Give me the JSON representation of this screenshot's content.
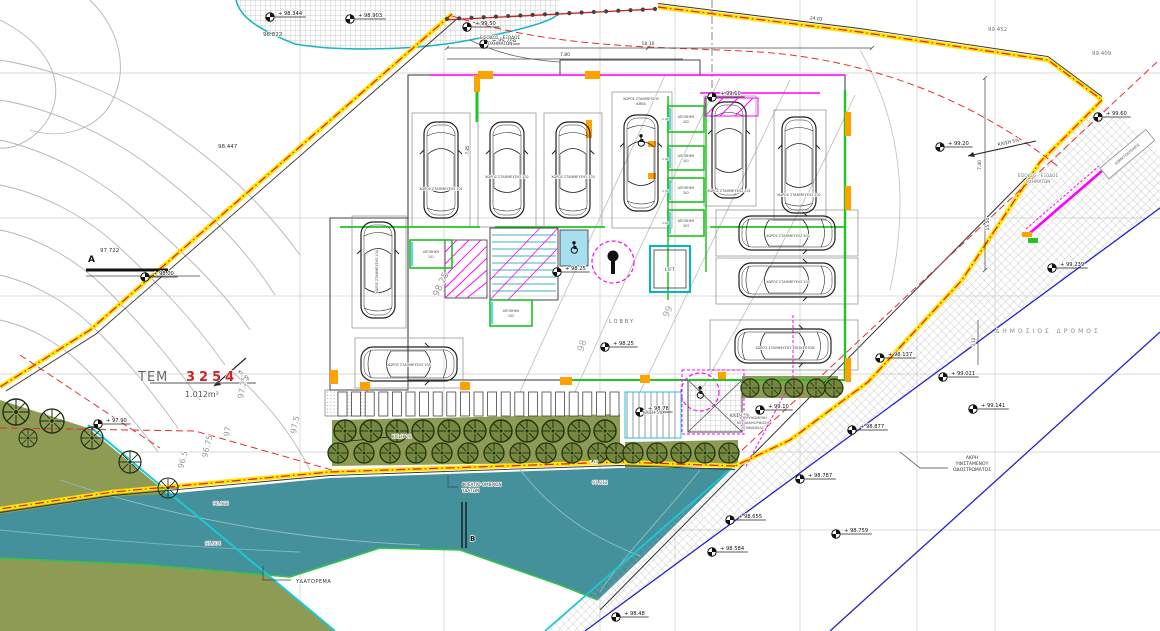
{
  "drawing": {
    "type": "topographic-site-plan",
    "parcel": {
      "id_prefix": "ΤΕΜ",
      "id_number": "3254",
      "area": "1.012m²"
    },
    "colors": {
      "water": "#44919b",
      "olive": "#8d9b55",
      "boundary_yellow": "#ffe500",
      "boundary_red": "#e01818",
      "wall_green": "#22c422",
      "wall_magenta": "#ff00ff",
      "road_blue": "#2222cc",
      "accent_orange": "#ffa200",
      "parcel_red": "#d42222"
    }
  },
  "markers": [
    {
      "x": 270,
      "y": 17,
      "t": "+ 98.344"
    },
    {
      "x": 350,
      "y": 19,
      "t": "+ 98.903"
    },
    {
      "x": 484,
      "y": 44,
      "t": "+ 99.268"
    },
    {
      "x": 467,
      "y": 27,
      "t": "+ 99.50"
    },
    {
      "x": 940,
      "y": 147,
      "t": "+ 99.20"
    },
    {
      "x": 1098,
      "y": 117,
      "t": "+ 99.60"
    },
    {
      "x": 1052,
      "y": 268,
      "t": "+ 99.239"
    },
    {
      "x": 943,
      "y": 377,
      "t": "+ 99.021"
    },
    {
      "x": 973,
      "y": 409,
      "t": "+ 99.141"
    },
    {
      "x": 852,
      "y": 430,
      "t": "+ 98.877"
    },
    {
      "x": 800,
      "y": 479,
      "t": "+ 98.787"
    },
    {
      "x": 730,
      "y": 520,
      "t": "+ 98.655"
    },
    {
      "x": 712,
      "y": 552,
      "t": "+ 98.584"
    },
    {
      "x": 836,
      "y": 534,
      "t": "+ 98.759"
    },
    {
      "x": 616,
      "y": 617,
      "t": "+ 98.48"
    },
    {
      "x": 145,
      "y": 277,
      "t": "+ 98.00"
    },
    {
      "x": 98,
      "y": 424,
      "t": "+ 97.90"
    },
    {
      "x": 605,
      "y": 347,
      "t": "+ 98.25"
    },
    {
      "x": 557,
      "y": 272,
      "t": "+ 98.25"
    },
    {
      "x": 712,
      "y": 97,
      "t": "+ 99.10"
    },
    {
      "x": 640,
      "y": 412,
      "t": "+ 98.78"
    },
    {
      "x": 760,
      "y": 410,
      "t": "+ 99.10"
    },
    {
      "x": 880,
      "y": 358,
      "t": "+ 98.137"
    }
  ],
  "texts": [
    {
      "x": 263,
      "y": 36,
      "t": "98.822",
      "s": 5.5
    },
    {
      "x": 218,
      "y": 148,
      "t": "98.447",
      "s": 5.5
    },
    {
      "x": 100,
      "y": 252,
      "t": "97.722",
      "s": 5.5
    },
    {
      "x": 988,
      "y": 31,
      "t": "99.452",
      "s": 5.5,
      "c": "#777"
    },
    {
      "x": 1092,
      "y": 55,
      "t": "99.409",
      "s": 5.5,
      "c": "#777"
    },
    {
      "x": 592,
      "y": 484,
      "t": "97.812",
      "s": 4.5,
      "c": "#555"
    },
    {
      "x": 205,
      "y": 545,
      "t": "97.004",
      "s": 4.5,
      "c": "#556"
    },
    {
      "x": 213,
      "y": 505,
      "t": "96.988",
      "s": 4.5,
      "c": "#556"
    },
    {
      "x": 500,
      "y": 39,
      "t": "ΕΙΣΟΔΟΣ - ΕΞΟΔΟΣ",
      "s": 4.2,
      "a": "middle"
    },
    {
      "x": 500,
      "y": 45,
      "t": "ΟΧΗΜΑΤΩΝ",
      "s": 4.2,
      "a": "middle"
    },
    {
      "x": 1038,
      "y": 177,
      "t": "ΕΙΣΟΔΟΣ - ΕΞΟΔΟΣ",
      "s": 4.2,
      "a": "middle",
      "c": "#777"
    },
    {
      "x": 1038,
      "y": 183,
      "t": "ΟΧΗΜΑΤΩΝ",
      "s": 4.2,
      "a": "middle",
      "c": "#777"
    },
    {
      "x": 138,
      "y": 381,
      "t": "ΤΕΜ",
      "s": 13,
      "c": "#666",
      "ls": 1
    },
    {
      "x": 186,
      "y": 381,
      "t": "3254",
      "s": 13,
      "c": "#d42222",
      "w": "bold",
      "ls": 4
    },
    {
      "x": 185,
      "y": 397,
      "t": "1.012m²",
      "s": 8,
      "c": "#555"
    },
    {
      "x": 296,
      "y": 583,
      "t": "ΥΔΑΤΟΡΕΜΑ",
      "s": 5,
      "ls": 0.5
    },
    {
      "x": 462,
      "y": 486,
      "t": "ΦΡΕΑΤΙΟ ΟΜΒΡΙΩΝ",
      "s": 4.2
    },
    {
      "x": 462,
      "y": 492,
      "t": "ΥΔΑΤΩΝ",
      "s": 4.2
    },
    {
      "x": 1048,
      "y": 333,
      "t": "ΔΗΜΟΣΙΟΣ ΔΡΟΜΟΣ",
      "s": 6,
      "c": "#8a8a8a",
      "ls": 3,
      "a": "middle"
    },
    {
      "x": 972,
      "y": 459,
      "t": "ΑΚΡΗ",
      "s": 4.5,
      "a": "middle"
    },
    {
      "x": 972,
      "y": 465,
      "t": "ΥΦΙΣΤΑΜΕΝΟΥ",
      "s": 4.5,
      "a": "middle"
    },
    {
      "x": 972,
      "y": 471,
      "t": "ΟΔΟΣΤΡΩΜΑΤΟΣ",
      "s": 4.5,
      "a": "middle"
    },
    {
      "x": 438,
      "y": 297,
      "t": "98.25",
      "s": 9,
      "r": -65,
      "c": "#999"
    },
    {
      "x": 583,
      "y": 352,
      "t": "98",
      "s": 9,
      "r": -72,
      "c": "#aaa"
    },
    {
      "x": 668,
      "y": 318,
      "t": "99",
      "s": 9,
      "r": -65,
      "c": "#aaa"
    },
    {
      "x": 243,
      "y": 399,
      "t": "97.25",
      "s": 8,
      "r": -78,
      "c": "#999"
    },
    {
      "x": 296,
      "y": 434,
      "t": "97.5",
      "s": 8,
      "r": -80,
      "c": "#999"
    },
    {
      "x": 229,
      "y": 437,
      "t": "97",
      "s": 8,
      "r": -80,
      "c": "#999"
    },
    {
      "x": 207,
      "y": 458,
      "t": "96.75",
      "s": 8,
      "r": -76,
      "c": "#999"
    },
    {
      "x": 183,
      "y": 469,
      "t": "96.5",
      "s": 8,
      "r": -74,
      "c": "#999"
    },
    {
      "x": 643,
      "y": 414,
      "t": "ΚΛΙΣΗ 5%",
      "s": 4
    },
    {
      "x": 730,
      "y": 417,
      "t": "ΚΛΙΣΗ 5%",
      "s": 4
    },
    {
      "x": 998,
      "y": 146,
      "t": "ΚΛΙΣΗ 5%",
      "s": 4.5,
      "r": -12
    },
    {
      "x": 392,
      "y": 438,
      "t": "ΚΛΙΣΗ 7%",
      "s": 4
    },
    {
      "x": 238,
      "y": 372,
      "t": "ΚΛ. 5%",
      "s": 3.8,
      "r": 40
    },
    {
      "x": 753,
      "y": 419,
      "t": "ΥΠΕΡΥΨΩΜΕΝΗ",
      "s": 3.6,
      "a": "middle",
      "c": "#555"
    },
    {
      "x": 753,
      "y": 424,
      "t": "ΝΕΟΔΙΑΜΟΡΦΩΣΗ",
      "s": 3.6,
      "a": "middle",
      "c": "#555"
    },
    {
      "x": 753,
      "y": 429,
      "t": "ΕΠΙΦΑΝΕΙΑΣ",
      "s": 3.6,
      "a": "middle",
      "c": "#555"
    },
    {
      "x": 441,
      "y": 190,
      "t": "ΧΩΡΟΣ ΣΤΑΘΜΕΥΣΗΣ 101",
      "s": 3.4,
      "a": "middle",
      "c": "#444"
    },
    {
      "x": 507,
      "y": 178,
      "t": "ΧΩΡΟΣ ΣΤΑΘΜΕΥΣΗΣ 102",
      "s": 3.4,
      "a": "middle",
      "c": "#444"
    },
    {
      "x": 573,
      "y": 178,
      "t": "ΧΩΡΟΣ ΣΤΑΘΜΕΥΣΗΣ 103",
      "s": 3.4,
      "a": "middle",
      "c": "#444"
    },
    {
      "x": 641,
      "y": 100,
      "t": "ΧΩΡΟΣ ΣΤΑΘΜΕΥΣΗΣ",
      "s": 3.4,
      "a": "middle",
      "c": "#444"
    },
    {
      "x": 641,
      "y": 105,
      "t": "ΑΜΕΑ",
      "s": 3.4,
      "a": "middle",
      "c": "#444"
    },
    {
      "x": 729,
      "y": 192,
      "t": "ΧΩΡΟΣ ΣΤΑΘΜΕΥΣΗΣ 201",
      "s": 3.4,
      "a": "middle",
      "c": "#444"
    },
    {
      "x": 799,
      "y": 196,
      "t": "ΧΩΡΟΣ ΣΤΑΘΜΕΥΣΗΣ 202",
      "s": 3.4,
      "a": "middle",
      "c": "#444"
    },
    {
      "x": 788,
      "y": 237,
      "t": "ΧΩΡΟΣ ΣΤΑΘΜΕΥΣΗΣ 302",
      "s": 3.4,
      "a": "middle",
      "c": "#444"
    },
    {
      "x": 788,
      "y": 283,
      "t": "ΧΩΡΟΣ ΣΤΑΘΜΕΥΣΗΣ 203",
      "s": 3.4,
      "a": "middle",
      "c": "#444"
    },
    {
      "x": 785,
      "y": 349,
      "t": "ΧΩΡΟΣ ΣΤΑΘΜΕΥΣΗΣ ΕΠΙΣΚΕΠΤΩΝ",
      "s": 3.4,
      "a": "middle",
      "c": "#444"
    },
    {
      "x": 378,
      "y": 272,
      "t": "ΧΩΡΟΣ ΣΤΑΘΜΕΥΣΗΣ 104",
      "s": 3.4,
      "a": "middle",
      "c": "#444",
      "r": -90
    },
    {
      "x": 409,
      "y": 366,
      "t": "ΧΩΡΟΣ ΣΤΑΘΜΕΥΣΗΣ 105",
      "s": 3.4,
      "a": "middle",
      "c": "#444"
    },
    {
      "x": 670,
      "y": 271,
      "t": "LIFT",
      "s": 4,
      "a": "middle",
      "ls": 0.5
    },
    {
      "x": 622,
      "y": 323,
      "t": "LOBBY",
      "s": 5,
      "c": "#666",
      "ls": 2,
      "a": "middle"
    },
    {
      "x": 648,
      "y": 45,
      "t": "18.10",
      "s": 4.5,
      "a": "middle"
    },
    {
      "x": 565,
      "y": 56,
      "t": "7.80",
      "s": 4.5,
      "a": "middle"
    },
    {
      "x": 816,
      "y": 20,
      "t": "24.03",
      "s": 4.5,
      "r": 7,
      "a": "middle"
    },
    {
      "x": 981,
      "y": 165,
      "t": "7.40",
      "s": 4.5,
      "r": -90,
      "a": "middle"
    },
    {
      "x": 989,
      "y": 224,
      "t": "15.50",
      "s": 4.5,
      "r": -90,
      "a": "middle"
    },
    {
      "x": 975,
      "y": 342,
      "t": "3.10",
      "s": 4,
      "r": -90,
      "a": "middle"
    },
    {
      "x": 469,
      "y": 150,
      "t": "7.85",
      "s": 4,
      "r": -90,
      "a": "middle"
    },
    {
      "x": 662,
      "y": 120,
      "t": "1.45",
      "s": 3
    },
    {
      "x": 662,
      "y": 160,
      "t": "1.40",
      "s": 3
    },
    {
      "x": 662,
      "y": 192,
      "t": "1.30",
      "s": 3
    },
    {
      "x": 662,
      "y": 224,
      "t": "1.20",
      "s": 3
    },
    {
      "x": 590,
      "y": 463,
      "t": "1.40",
      "s": 3.5,
      "c": "#444"
    },
    {
      "x": 88,
      "y": 262,
      "t": "A",
      "s": 9,
      "w": "bold",
      "c": "#111"
    },
    {
      "x": 470,
      "y": 541,
      "t": "B",
      "s": 7,
      "w": "bold",
      "c": "#111"
    },
    {
      "x": 1128,
      "y": 155,
      "t": "ΧΩΜΑΤΟΔΡΟΜΟΣ",
      "s": 3.6,
      "r": -40,
      "a": "middle",
      "c": "#555"
    }
  ],
  "storages": [
    {
      "x": 668,
      "y": 106,
      "w": 36,
      "h": 26,
      "label": "ΑΠΟΘΗΚΗ 202"
    },
    {
      "x": 668,
      "y": 146,
      "w": 36,
      "h": 24,
      "label": "ΑΠΟΘΗΚΗ 301"
    },
    {
      "x": 668,
      "y": 178,
      "w": 36,
      "h": 24,
      "label": "ΑΠΟΘΗΚΗ 302"
    },
    {
      "x": 668,
      "y": 210,
      "w": 36,
      "h": 26,
      "label": "ΑΠΟΘΗΚΗ 303"
    },
    {
      "x": 410,
      "y": 240,
      "w": 42,
      "h": 28,
      "label": "ΑΠΟΘΗΚΗ 101"
    },
    {
      "x": 490,
      "y": 300,
      "w": 42,
      "h": 26,
      "label": "ΑΠΟΘΗΚΗ 102"
    }
  ],
  "bays": [
    [
      412,
      113,
      58,
      114
    ],
    [
      478,
      113,
      58,
      114
    ],
    [
      544,
      113,
      58,
      114
    ],
    [
      612,
      92,
      60,
      136
    ],
    [
      704,
      96,
      52,
      110
    ],
    [
      774,
      110,
      52,
      110
    ],
    [
      352,
      216,
      54,
      112
    ],
    [
      355,
      338,
      108,
      50
    ],
    [
      716,
      210,
      142,
      46
    ],
    [
      716,
      258,
      142,
      46
    ],
    [
      710,
      320,
      148,
      50
    ]
  ],
  "cars": [
    [
      441,
      170,
      0
    ],
    [
      507,
      170,
      0
    ],
    [
      573,
      170,
      0
    ],
    [
      641,
      163,
      0
    ],
    [
      729,
      150,
      0
    ],
    [
      799,
      165,
      0
    ],
    [
      378,
      270,
      0
    ],
    [
      409,
      364,
      90
    ],
    [
      787,
      233,
      90
    ],
    [
      787,
      280,
      90
    ],
    [
      783,
      346,
      90
    ]
  ],
  "wheelchairs": [
    [
      641,
      140
    ],
    [
      574,
      247
    ],
    [
      700,
      392
    ]
  ],
  "trees": [
    [
      16,
      412,
      13
    ],
    [
      52,
      421,
      12
    ],
    [
      28,
      438,
      9
    ],
    [
      92,
      438,
      11
    ],
    [
      130,
      462,
      11
    ],
    [
      168,
      488,
      10
    ]
  ],
  "bushes": [
    [
      345,
      431,
      11
    ],
    [
      371,
      431,
      11
    ],
    [
      397,
      431,
      11
    ],
    [
      423,
      431,
      11
    ],
    [
      449,
      431,
      11
    ],
    [
      475,
      431,
      11
    ],
    [
      501,
      431,
      11
    ],
    [
      527,
      431,
      11
    ],
    [
      553,
      431,
      11
    ],
    [
      579,
      431,
      11
    ],
    [
      605,
      431,
      11
    ],
    [
      338,
      453,
      10
    ],
    [
      364,
      453,
      10
    ],
    [
      390,
      453,
      10
    ],
    [
      416,
      453,
      10
    ],
    [
      442,
      453,
      10
    ],
    [
      468,
      453,
      10
    ],
    [
      494,
      453,
      10
    ],
    [
      520,
      453,
      10
    ],
    [
      546,
      453,
      10
    ],
    [
      572,
      453,
      10
    ],
    [
      598,
      453,
      10
    ],
    [
      616,
      453,
      10
    ],
    [
      633,
      453,
      10
    ],
    [
      657,
      453,
      10
    ],
    [
      681,
      453,
      10
    ],
    [
      705,
      453,
      10
    ],
    [
      729,
      453,
      10
    ],
    [
      750,
      388,
      9
    ],
    [
      772,
      388,
      9
    ],
    [
      794,
      388,
      9
    ],
    [
      816,
      388,
      9
    ],
    [
      834,
      388,
      9
    ]
  ],
  "deck": {
    "x0": 338,
    "y": 392,
    "n": 21,
    "step": 13.6,
    "w": 9,
    "h": 24
  },
  "dots_row": {
    "x1": 447,
    "y1": 19,
    "x2": 655,
    "y2": 9,
    "n": 18
  }
}
